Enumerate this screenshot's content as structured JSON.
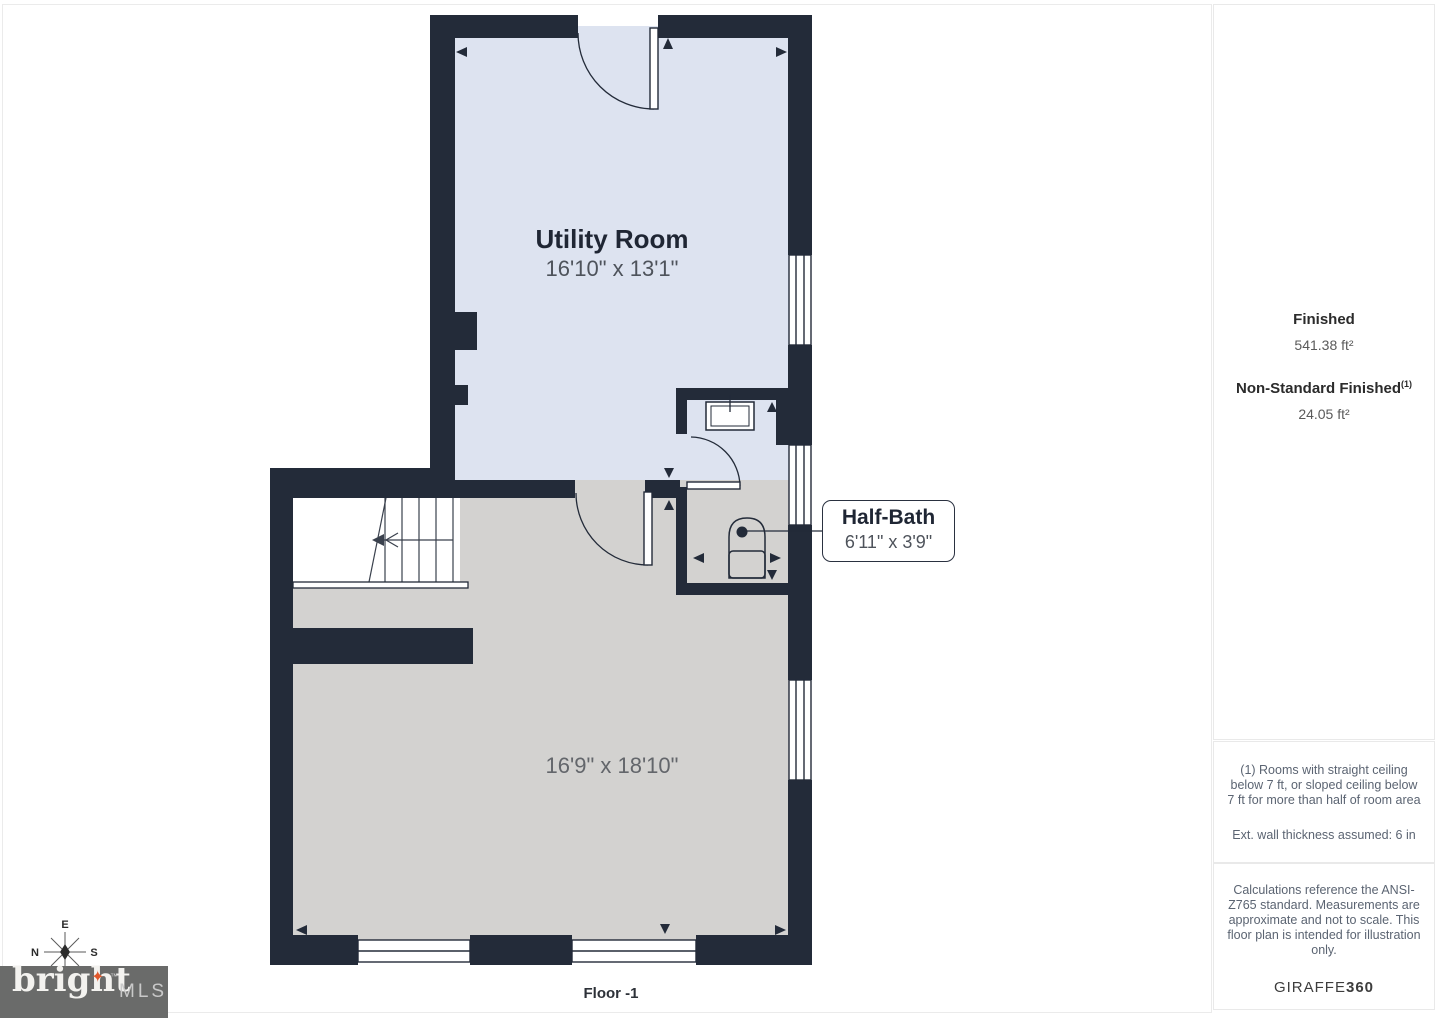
{
  "plan": {
    "utility_room": {
      "name": "Utility Room",
      "dims": "16'10\" x 13'1\""
    },
    "half_bath": {
      "name": "Half-Bath",
      "dims": "6'11\" x 3'9\""
    },
    "main_room": {
      "dims": "16'9\" x 18'10\""
    },
    "floor_label": "Floor -1"
  },
  "sidebar": {
    "finished_label": "Finished",
    "finished_value": "541.38 ft²",
    "non_standard_label": "Non-Standard Finished",
    "non_standard_sup": "(1)",
    "non_standard_value": "24.05 ft²",
    "footnote_ceiling": "(1) Rooms with straight ceiling below 7 ft, or sloped ceiling below 7 ft for more than half of room area",
    "footnote_wall": "Ext. wall thickness assumed: 6 in",
    "disclaimer": "Calculations reference the ANSI-Z765 standard. Measurements are approximate and not to scale. This floor plan is intended for illustration only.",
    "brand_name": "GIRAFFE",
    "brand_suffix": "360"
  },
  "compass": {
    "e": "E",
    "n": "N",
    "s": "S"
  },
  "logo": {
    "word": "bright",
    "star_glyph": "✦",
    "tm": "™",
    "mls": "MLS"
  },
  "colors": {
    "wall": "#232b39",
    "finished_room": "#dde3f0",
    "unfinished_room": "#d3d2d0",
    "logo_box": "#6a6b6a",
    "star": "#e0572b"
  }
}
